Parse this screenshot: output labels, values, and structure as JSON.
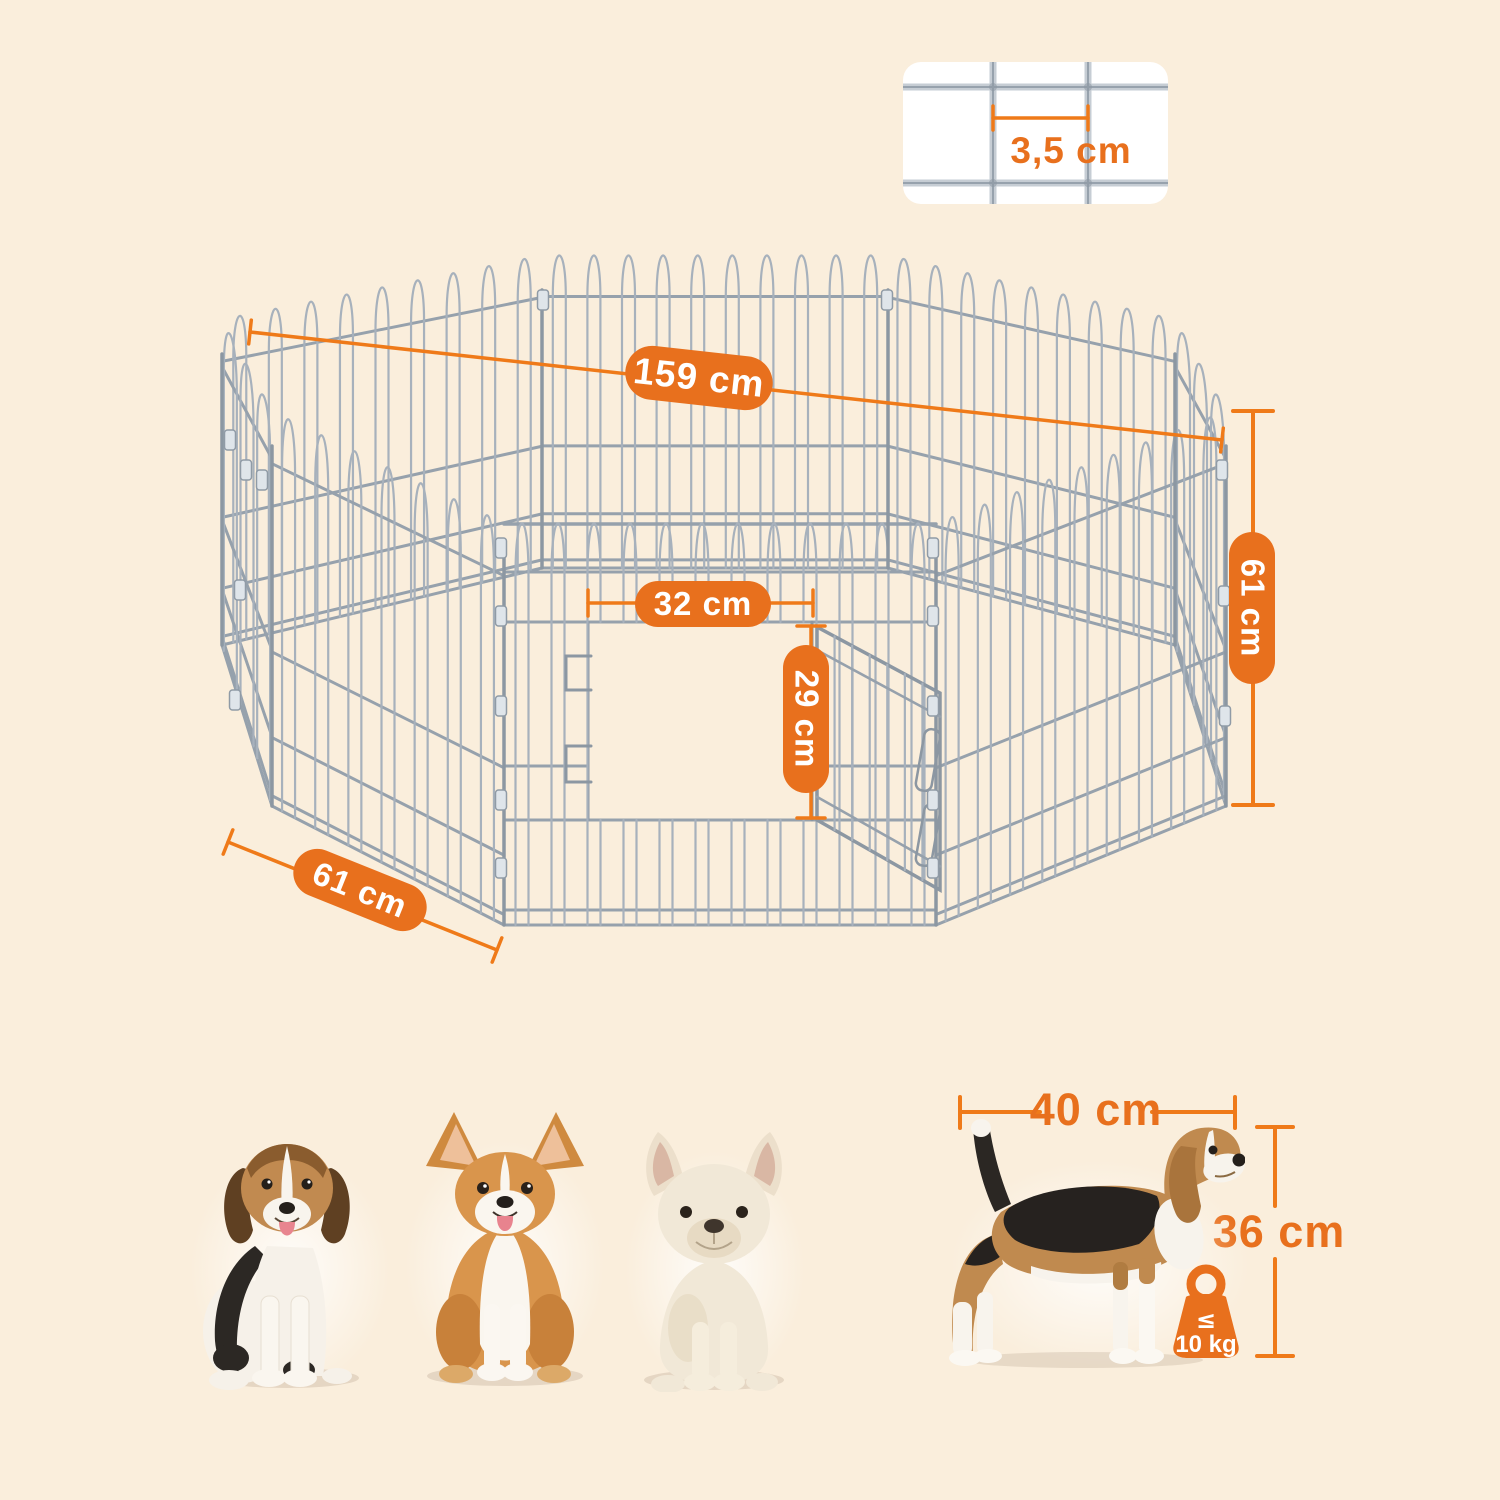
{
  "theme": {
    "background": "#FAEEDC",
    "accent": "#E8701D",
    "line": "#EF7A19",
    "wire": "#A7B1BC",
    "card": "#FFFFFF",
    "text_on_accent": "#FFFFFF"
  },
  "mesh_detail": {
    "label": "3,5 cm"
  },
  "pen_labels": {
    "diagonal": "159 cm",
    "door_width": "32 cm",
    "door_height": "29 cm",
    "height": "61 cm",
    "panel_width": "61 cm"
  },
  "dog_dims": {
    "length": "40 cm",
    "height": "36 cm"
  },
  "weight": {
    "operator": "≤",
    "value": "10 kg"
  },
  "dogs": [
    {
      "name": "beagle puppy"
    },
    {
      "name": "welsh corgi"
    },
    {
      "name": "french bulldog"
    },
    {
      "name": "beagle side view"
    }
  ]
}
